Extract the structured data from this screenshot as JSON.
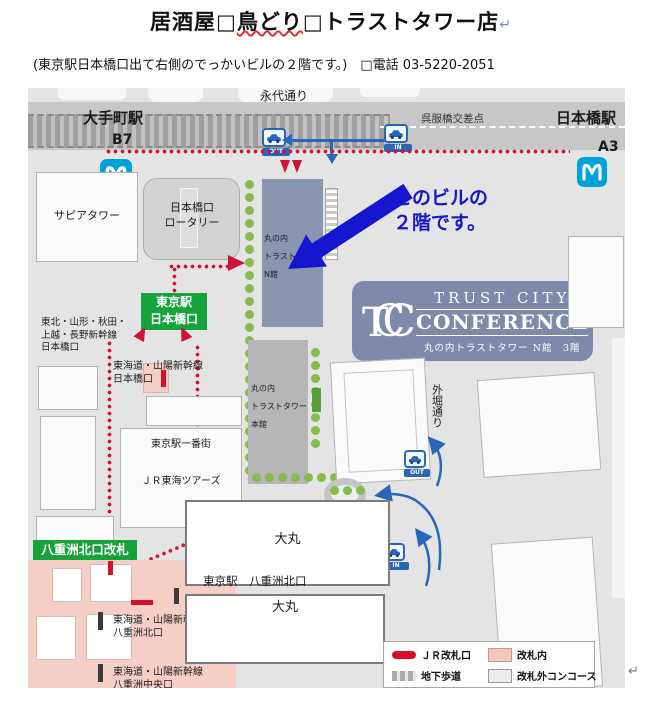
{
  "page": {
    "title_p1": "居酒屋□",
    "title_misspelled": "鳥どり",
    "title_p2": "□トラストタワー店",
    "return_mark": "↵",
    "subtitle": "(東京駅日本橋口出て右側のでっかいビルの２階です。)　□電話 03-5220-2051",
    "cursor_mark": "↵"
  },
  "map": {
    "roads": {
      "eitai": "永代通り",
      "sotobori": "外堀通り",
      "gofukubashi_crossing": "呉服橋交差点"
    },
    "stations": {
      "otemachi": "大手町駅",
      "otemachi_exit": "B7",
      "nihombashi": "日本橋駅",
      "nihombashi_exit": "A3"
    },
    "badges": {
      "tokyo_nihombashi_l1": "東京駅",
      "tokyo_nihombashi_l2": "日本橋口",
      "yaesu_north_gate": "八重洲北口改札"
    },
    "buildings": {
      "sapia": "サピアタワー",
      "rotary_l1": "日本橋口",
      "rotary_l2": "ロータリー",
      "n_tower_l1": "丸の内",
      "n_tower_l2": "トラストタワー",
      "n_tower_l3": "N館",
      "main_tower_l1": "丸の内",
      "main_tower_l2": "トラストタワー",
      "main_tower_l3": "本館",
      "ichibangai": "東京駅一番街",
      "jr_tours": "ＪＲ東海ツアーズ",
      "daimaru_upper": "大丸",
      "daimaru_lower": "大丸",
      "tokyo_yaesu_north": "東京駅　八重洲北口"
    },
    "shinkansen": {
      "tohoku_l1": "東北・山形・秋田・",
      "tohoku_l2": "上越・長野新幹線",
      "tohoku_l3": "日本橋口",
      "tokaido_nihombashi_l1": "東海道・山陽新幹線",
      "tokaido_nihombashi_l2": "日本橋口",
      "tokaido_yaesu_north_l1": "東海道・山陽新幹線",
      "tokaido_yaesu_north_l2": "八重洲北口",
      "tokaido_yaesu_center_l1": "東海道・山陽新幹線",
      "tokaido_yaesu_center_l2": "八重洲中央口"
    },
    "annotation": {
      "l1": "このビルの",
      "l2": "２階です。"
    },
    "tcc": {
      "t": "T",
      "c1": "C",
      "c2": "C",
      "name_l1": "TRUST CITY",
      "name_l2": "CONFERENCE",
      "address": "丸の内トラストタワー N館　3階"
    },
    "traffic": {
      "out_top": "OUT",
      "in_top": "IN",
      "out_side": "OUT",
      "in_side": "IN"
    },
    "legend": {
      "items": [
        {
          "label": "ＪＲ改札口"
        },
        {
          "label": "改札内"
        },
        {
          "label": "地下歩道"
        },
        {
          "label": "改札外コンコース"
        }
      ]
    },
    "colors": {
      "route_red": "#cf1236",
      "metro_blue": "#00a3d9",
      "traffic_blue": "#2a66b8",
      "annotation_blue": "#1717c4",
      "badge_green": "#17a33c",
      "n_tower_fill": "#8a95b0",
      "tcc_badge": "#7d8aaa",
      "inside_gate_pink": "#f5cec6"
    }
  }
}
